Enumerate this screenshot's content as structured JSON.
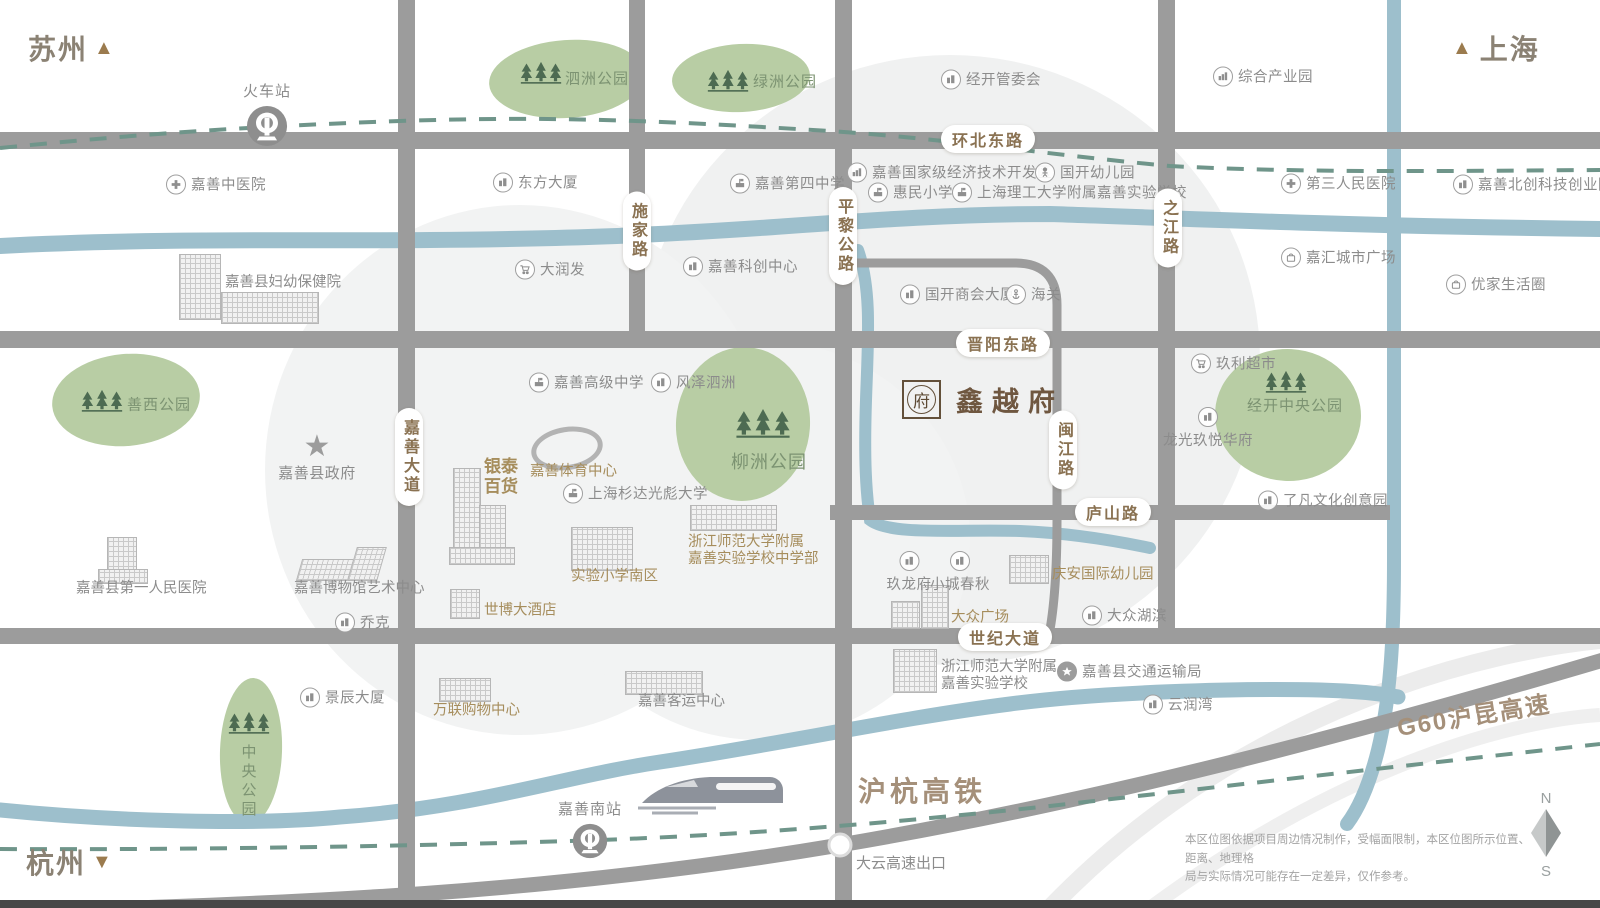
{
  "corners": {
    "suzhou": "苏州",
    "shanghai": "上海",
    "hangzhou": "杭州"
  },
  "project": {
    "name": "鑫越府",
    "seal": "府"
  },
  "government": {
    "name": "嘉善县政府"
  },
  "stations": [
    {
      "name": "火车站"
    },
    {
      "name": "嘉善南站"
    }
  ],
  "railways": {
    "high_speed": "沪杭高铁",
    "g60": "G60沪昆高速",
    "exit": "大云高速出口"
  },
  "road_labels": [
    {
      "t": "环北东路",
      "x": 988,
      "y": 139
    },
    {
      "t": "晋阳东路",
      "x": 1003,
      "y": 343
    },
    {
      "t": "庐山路",
      "x": 1113,
      "y": 512
    },
    {
      "t": "世纪大道",
      "x": 1005,
      "y": 637
    },
    {
      "t": "施家路",
      "x": 637,
      "y": 231,
      "v": 1
    },
    {
      "t": "平黎公路",
      "x": 843,
      "y": 236,
      "v": 1
    },
    {
      "t": "之江路",
      "x": 1168,
      "y": 228,
      "v": 1
    },
    {
      "t": "闽江路",
      "x": 1063,
      "y": 450,
      "v": 1
    },
    {
      "t": "嘉善大道",
      "x": 409,
      "y": 457,
      "v": 1
    }
  ],
  "parks": [
    {
      "name": "泗洲公园",
      "blob": {
        "cx": 567,
        "cy": 79,
        "rx": 78,
        "ry": 39,
        "rot": -4
      },
      "trees": {
        "x": 541,
        "y": 74
      },
      "label": {
        "x": 565,
        "y": 78
      }
    },
    {
      "name": "绿洲公园",
      "blob": {
        "cx": 741,
        "cy": 78,
        "rx": 69,
        "ry": 34,
        "rot": -3
      },
      "trees": {
        "x": 728,
        "y": 82
      },
      "label": {
        "x": 753,
        "y": 81
      }
    },
    {
      "name": "善西公园",
      "blob": {
        "cx": 126,
        "cy": 400,
        "rx": 74,
        "ry": 46,
        "rot": -5
      },
      "trees": {
        "x": 102,
        "y": 402
      },
      "label": {
        "x": 127,
        "y": 404
      }
    },
    {
      "name": "柳洲公园",
      "blob": {
        "cx": 743,
        "cy": 424,
        "rx": 67,
        "ry": 77,
        "rot": 4
      },
      "trees": {
        "x": 763,
        "y": 425,
        "s": 58
      },
      "label": {
        "x": 731,
        "y": 461,
        "size": 18
      }
    },
    {
      "name": "经开中央公园",
      "blob": {
        "cx": 1288,
        "cy": 415,
        "rx": 73,
        "ry": 66,
        "rot": 3
      },
      "trees": {
        "x": 1286,
        "y": 383
      },
      "label": {
        "x": 1247,
        "y": 405
      }
    },
    {
      "name": "中央公园",
      "blob": {
        "cx": 251,
        "cy": 751,
        "rx": 31,
        "ry": 73,
        "rot": 2
      },
      "trees": {
        "x": 249,
        "y": 724
      },
      "label": {
        "x": 248,
        "y": 744,
        "v": 1
      }
    }
  ],
  "pois": [
    {
      "t": "嘉善中医院",
      "i": "hospital",
      "x": 175,
      "y": 184
    },
    {
      "t": "东方大厦",
      "i": "building",
      "x": 502,
      "y": 182
    },
    {
      "t": "嘉善第四中学",
      "i": "school",
      "x": 739,
      "y": 183
    },
    {
      "t": "经开管委会",
      "i": "building",
      "x": 950,
      "y": 79
    },
    {
      "t": "综合产业园",
      "i": "factory",
      "x": 1222,
      "y": 76
    },
    {
      "t": "嘉善国家级经济技术开发区",
      "i": "factory",
      "x": 856,
      "y": 172
    },
    {
      "t": "国开幼儿园",
      "i": "kid",
      "x": 1044,
      "y": 172
    },
    {
      "t": "惠民小学",
      "i": "school",
      "x": 877,
      "y": 192
    },
    {
      "t": "上海理工大学附属嘉善实验学校",
      "i": "school",
      "x": 961,
      "y": 192
    },
    {
      "t": "第三人民医院",
      "i": "hospital",
      "x": 1290,
      "y": 183
    },
    {
      "t": "嘉善北创科技创业园",
      "i": "building",
      "x": 1462,
      "y": 184
    },
    {
      "t": "嘉汇城市广场",
      "i": "mall",
      "x": 1290,
      "y": 257
    },
    {
      "t": "优家生活圈",
      "i": "mall",
      "x": 1455,
      "y": 284
    },
    {
      "t": "大润发",
      "i": "cart",
      "x": 524,
      "y": 269
    },
    {
      "t": "嘉善科创中心",
      "i": "building",
      "x": 692,
      "y": 266
    },
    {
      "t": "国开商会大厦",
      "i": "building",
      "x": 909,
      "y": 294
    },
    {
      "t": "海关",
      "i": "anchor",
      "x": 1015,
      "y": 294
    },
    {
      "t": "玖利超市",
      "i": "cart",
      "x": 1200,
      "y": 363
    },
    {
      "t": "龙光玖悦华府",
      "i": "building",
      "x": 1208,
      "y": 416,
      "lp": "below"
    },
    {
      "t": "了凡文化创意园",
      "i": "building",
      "x": 1267,
      "y": 500
    },
    {
      "t": "嘉善高级中学",
      "i": "school",
      "x": 538,
      "y": 382
    },
    {
      "t": "风泽泗洲",
      "i": "building",
      "x": 660,
      "y": 382
    },
    {
      "t": "上海杉达光彪大学",
      "i": "school",
      "x": 572,
      "y": 493
    },
    {
      "t": "乔克",
      "i": "building",
      "x": 344,
      "y": 622
    },
    {
      "t": "景辰大厦",
      "i": "building",
      "x": 309,
      "y": 697
    },
    {
      "t": "玖龙府",
      "i": "building",
      "x": 909,
      "y": 560,
      "lp": "below"
    },
    {
      "t": "小城春秋",
      "i": "building",
      "x": 960,
      "y": 560,
      "lp": "below"
    },
    {
      "t": "大众湖滨",
      "i": "building",
      "x": 1091,
      "y": 615
    },
    {
      "t": "嘉善县交通运输局",
      "i": "star",
      "x": 1066,
      "y": 671
    },
    {
      "t": "云润湾",
      "i": "building",
      "x": 1152,
      "y": 704
    }
  ],
  "landmarks": [
    {
      "t": "嘉善县妇幼保健院",
      "tone": "g",
      "cap": {
        "x": 225,
        "y": 283
      },
      "parts": [
        [
          179,
          254,
          40,
          64
        ],
        [
          221,
          292,
          96,
          30
        ]
      ]
    },
    {
      "t": "嘉善县第一人民医院",
      "tone": "g",
      "cap": {
        "x": 76,
        "y": 589
      },
      "parts": [
        [
          107,
          537,
          28,
          44
        ],
        [
          98,
          569,
          48,
          13
        ]
      ]
    },
    {
      "t": "嘉善博物馆艺术中心",
      "tone": "g",
      "kind": "wedge",
      "cap": {
        "x": 294,
        "y": 589
      },
      "parts": [
        [
          299,
          559,
          50,
          20
        ],
        [
          352,
          547,
          28,
          32
        ]
      ]
    },
    {
      "t": "银泰\n百货",
      "tone": "b",
      "cap": {
        "x": 484,
        "y": 477,
        "size": 17,
        "bold": 1
      },
      "parts": [
        [
          453,
          468,
          26,
          94
        ],
        [
          479,
          505,
          25,
          58
        ],
        [
          449,
          547,
          64,
          16
        ]
      ]
    },
    {
      "t": "嘉善体育中心",
      "tone": "b",
      "kind": "stadium",
      "cap": {
        "x": 530,
        "y": 472
      },
      "parts": [
        [
          531,
          427,
          62,
          33
        ]
      ]
    },
    {
      "t": "实验小学南区",
      "tone": "b",
      "cap": {
        "x": 571,
        "y": 577
      },
      "parts": [
        [
          571,
          527,
          60,
          42
        ]
      ]
    },
    {
      "t": "浙江师范大学附属\n嘉善实验学校中学部",
      "tone": "b",
      "cap": {
        "x": 688,
        "y": 551
      },
      "parts": [
        [
          690,
          505,
          85,
          24
        ]
      ]
    },
    {
      "t": "世博大酒店",
      "tone": "b",
      "cap": {
        "x": 484,
        "y": 611
      },
      "parts": [
        [
          450,
          589,
          28,
          28
        ]
      ]
    },
    {
      "t": "庆安国际幼儿园",
      "tone": "b",
      "cap": {
        "x": 1052,
        "y": 575
      },
      "parts": [
        [
          1009,
          555,
          38,
          27
        ]
      ]
    },
    {
      "t": "大众广场",
      "tone": "b",
      "cap": {
        "x": 951,
        "y": 618
      },
      "parts": [
        [
          891,
          601,
          27,
          26
        ],
        [
          921,
          585,
          26,
          42
        ]
      ]
    },
    {
      "t": "万联购物中心",
      "tone": "b",
      "cap": {
        "x": 433,
        "y": 711
      },
      "parts": [
        [
          439,
          678,
          50,
          22
        ]
      ]
    },
    {
      "t": "嘉善客运中心",
      "tone": "g",
      "cap": {
        "x": 638,
        "y": 702
      },
      "parts": [
        [
          625,
          671,
          76,
          22
        ]
      ]
    },
    {
      "t": "浙江师范大学附属\n嘉善实验学校",
      "tone": "g",
      "cap": {
        "x": 941,
        "y": 676
      },
      "parts": [
        [
          893,
          649,
          42,
          42
        ]
      ]
    }
  ],
  "disclaimer": [
    "本区位图依据项目周边情况制作，受幅面限制，本区位图所示位置、距离、地理格",
    "局与实际情况可能存在一定差异，仅作参考。"
  ],
  "compass": {
    "north": "N",
    "south": "S"
  },
  "colors": {
    "road": "#9c9c9c",
    "river": "#9dbfcc",
    "park": "#b8cda4",
    "rail_dash": "#6f958a",
    "accent_brown": "#a68d5c",
    "label_gray": "#8c8c8c",
    "park_text": "#7c9372"
  }
}
